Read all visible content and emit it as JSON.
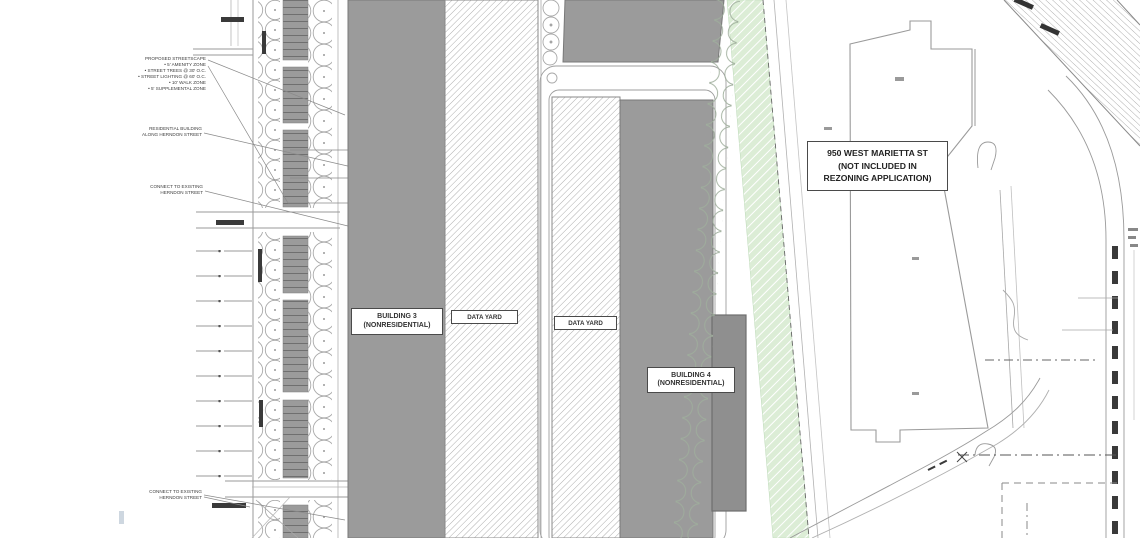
{
  "labels": {
    "building3": {
      "line1": "BUILDING 3",
      "line2": "(NONRESIDENTIAL)"
    },
    "data_yard_west": "DATA YARD",
    "data_yard_east": "DATA YARD",
    "building4": {
      "line1": "BUILDING 4",
      "line2": "(NONRESIDENTIAL)"
    },
    "parcel_950": {
      "line1": "950 WEST MARIETTA ST",
      "line2": "(NOT INCLUDED IN",
      "line3": "REZONING APPLICATION)"
    }
  },
  "annotations": {
    "streetscape": {
      "title": "PROPOSED STREETSCAPE",
      "items": [
        "•  5' AMENITY ZONE",
        "•  STREET TREES @ 30' O.C.",
        "•  STREET LIGHTING @ 60' O.C.",
        "•  10' WALK ZONE",
        "•  5' SUPPLEMENTAL ZONE"
      ]
    },
    "residential": {
      "line1": "RESIDENTIAL BUILDING",
      "line2": "ALONG HERNDON STREET"
    },
    "connect_north": {
      "line1": "CONNECT TO EXISTING",
      "line2": "HERNDON STREET"
    },
    "connect_south": {
      "line1": "CONNECT TO EXISTING",
      "line2": "HERNDON STREET"
    }
  },
  "colors": {
    "building_fill": "#9b9b9b",
    "stall_line": "#6f6f6f",
    "yard_hatch_line": "#9a9a9a",
    "buffer_green": "#dcedd6",
    "tree_outline": "#a8a8a8",
    "rail_stripe": "#a8a8a8",
    "annotation_text": "#3e3e3e"
  }
}
